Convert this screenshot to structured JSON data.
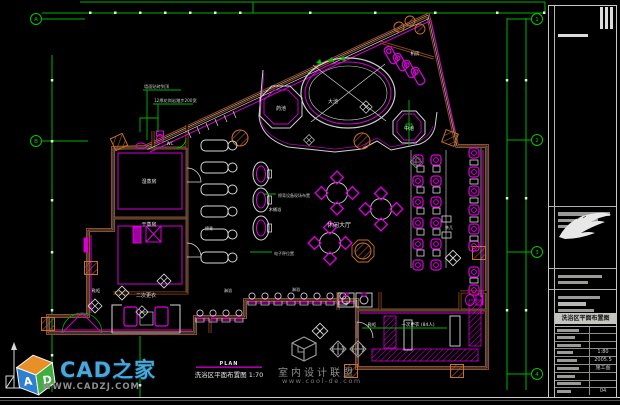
{
  "colors": {
    "background": "#000000",
    "wall_brown": "#9a4a1e",
    "wall_light": "#c8702c",
    "magenta": "#e000e0",
    "green": "#00b400",
    "white": "#d8d8d8",
    "gray": "#8f8f8f",
    "logo_blue": "#4aa7d8"
  },
  "plan": {
    "rooms": {
      "machine_room": "机房",
      "big_pool": "大池",
      "herb_pool": "药池",
      "medium_pool": "中池",
      "wc": "WC",
      "wet_steam_room": "湿蒸房",
      "dry_steam_room": "干蒸房",
      "scrub_bed": "擦背",
      "wood_tub": "木桶浴",
      "leisure_hall": "休闲大厅",
      "shower_left": "淋浴",
      "shower_right": "淋浴",
      "second_changing": "二次更衣",
      "shoe_cabinet_left": "鞋柜",
      "shoe_cabinet_right": "鞋柜",
      "first_changing": "一次更衣 (84人)",
      "tea_table": "茶几"
    },
    "annotations": {
      "wall_note": "墙面贴砖到顶",
      "step_note": "12厚花岗岩踏步200宽",
      "scrub_note": "擦背设备现场布置",
      "scale_note": "电子秤位置"
    },
    "caption": {
      "plan_word": "PLAN",
      "title": "洗浴区平面布置图 1:70"
    },
    "grid": {
      "left_bubbles": [
        "A",
        "B"
      ],
      "right_bubbles": [
        "1",
        "2",
        "3",
        "4"
      ]
    }
  },
  "watermark": {
    "name": "室内设计联盟",
    "url": "www.cool-de.com"
  },
  "site_logo": {
    "name": "CAD之家",
    "url": "WWW.CADZJ.COM",
    "cube_letter_a": "A",
    "cube_letter_d": "D"
  },
  "title_block": {
    "drawing_title": "洗浴区平面布置图",
    "scale": "1:80",
    "date": "2005.5",
    "stage": "施工图",
    "sheet_no": "04"
  }
}
